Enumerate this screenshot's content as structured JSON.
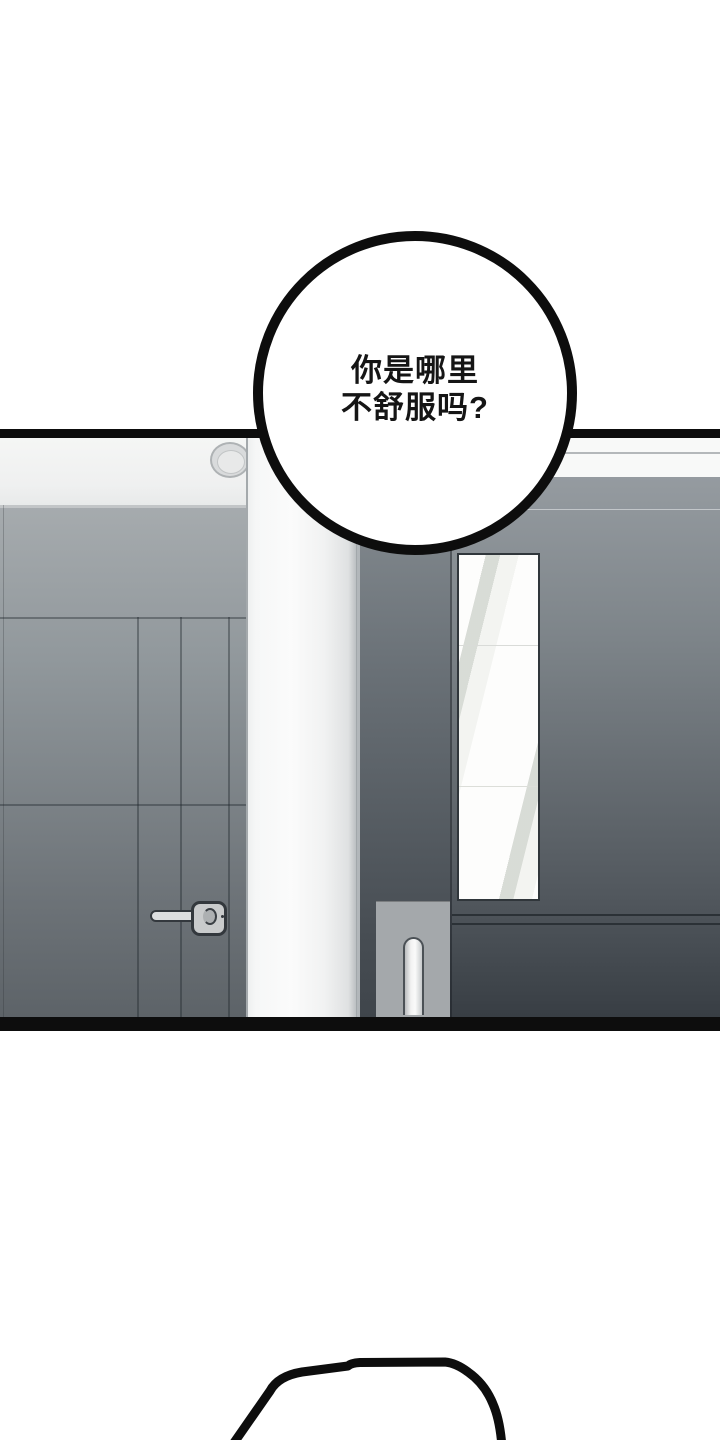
{
  "speech_bubble": {
    "lines": [
      "你是哪里",
      "不舒服吗?"
    ]
  },
  "colors": {
    "page_bg": "#ffffff",
    "ink": "#0d0d0d",
    "bubble_fill": "#ffffff",
    "text_color": "#151515",
    "ceiling": "#f3f4f3",
    "left_door_top": "#a6abae",
    "left_door_bottom": "#5d6368",
    "pillar": "#f3f4f4",
    "middle_door_top": "#878e93",
    "middle_door_bottom": "#3f454b",
    "right_wall_top": "#959ba0",
    "right_wall_bottom": "#383e44",
    "mirror": "#fdfdfc",
    "handle_plate": "#c9cbcc",
    "push_plate": "#a4a8ab"
  }
}
